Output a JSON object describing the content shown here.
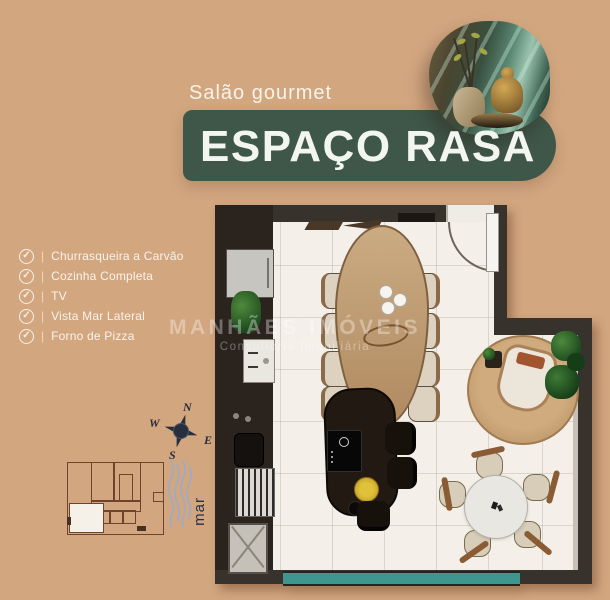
{
  "page": {
    "background": "#d2a67f"
  },
  "header": {
    "subtitle": "Salão gourmet",
    "title": "ESPAÇO RASA"
  },
  "features": {
    "separator": "|",
    "check_glyph": "✓",
    "items": [
      {
        "label": "Churrasqueira a Carvão"
      },
      {
        "label": "Cozinha Completa"
      },
      {
        "label": "TV"
      },
      {
        "label": "Vista Mar Lateral"
      },
      {
        "label": "Forno de Pizza"
      }
    ]
  },
  "compass": {
    "north": "N",
    "east": "E",
    "south": "S",
    "west": "W"
  },
  "map": {
    "sea_label": "mar"
  },
  "watermark": {
    "line1": "MANHÃES IMÓVEIS",
    "line2": "Consultoria Imobiliária"
  },
  "colors": {
    "background_tan": "#d2a67f",
    "banner_green": "#3f5748",
    "wall_dark": "#38322c",
    "floor": "#f4f0e9",
    "window_teal": "#3f968f",
    "rug_tan": "#c49e72"
  }
}
